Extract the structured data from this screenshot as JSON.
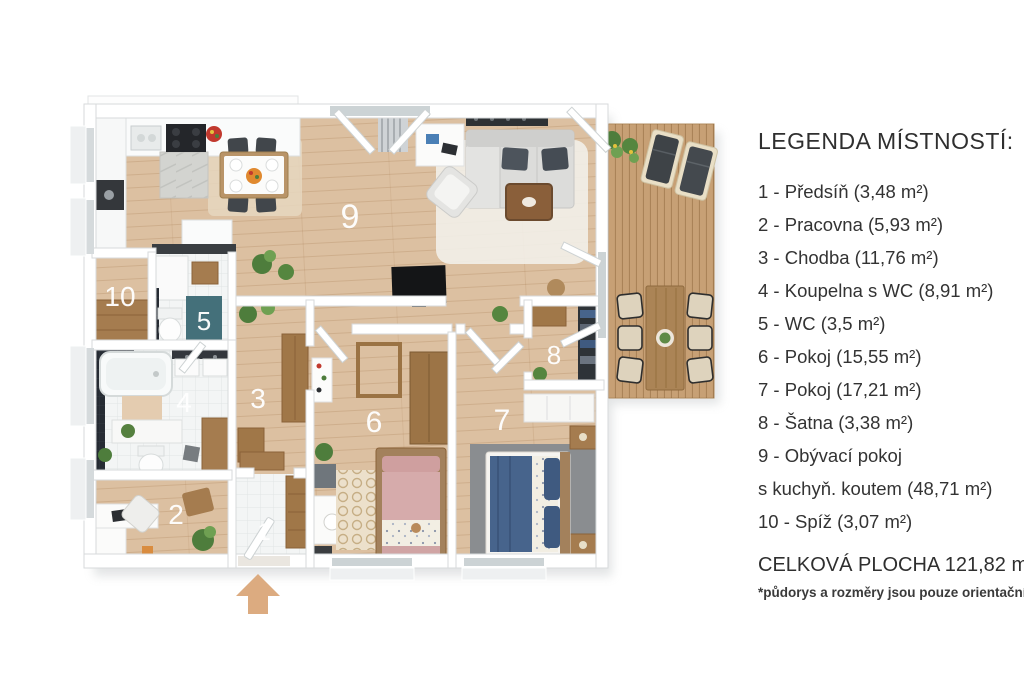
{
  "legend": {
    "title": "LEGENDA MÍSTNOSTÍ:",
    "items": [
      {
        "line1": "1 - Předsíň (3,48 m²)"
      },
      {
        "line1": "2 - Pracovna (5,93 m²)"
      },
      {
        "line1": "3 - Chodba (11,76 m²)"
      },
      {
        "line1": "4 - Koupelna s WC (8,91 m²)"
      },
      {
        "line1": "5 - WC (3,5 m²)"
      },
      {
        "line1": "6 - Pokoj (15,55 m²)"
      },
      {
        "line1": "7 - Pokoj (17,21 m²)"
      },
      {
        "line1": "8 - Šatna (3,38 m²)"
      },
      {
        "line1": "9 - Obývací pokoj",
        "line2": "s kuchyň. koutem (48,71 m²)"
      },
      {
        "line1": "10 - Spíž (3,07 m²)"
      }
    ],
    "total": "CELKOVÁ PLOCHA 121,82 m²",
    "disclaimer": "*půdorys a rozměry jsou pouze orientační"
  },
  "plan": {
    "labels": [
      {
        "number": "1",
        "room": "predsin"
      },
      {
        "number": "2",
        "room": "pracovna"
      },
      {
        "number": "3",
        "room": "chodba"
      },
      {
        "number": "4",
        "room": "koupelna-s-wc"
      },
      {
        "number": "5",
        "room": "wc"
      },
      {
        "number": "6",
        "room": "pokoj-6"
      },
      {
        "number": "7",
        "room": "pokoj-7"
      },
      {
        "number": "8",
        "room": "satna"
      },
      {
        "number": "9",
        "room": "obyvaci-pokoj-s-kuchyni"
      },
      {
        "number": "10",
        "room": "spiz"
      }
    ],
    "colors": {
      "floor_wood": "#dcc0a1",
      "deck_wood": "#c7a075",
      "tile": "#f3f5f5",
      "wall": "#ffffff",
      "teal_mat": "#44707a",
      "arrow": "#dcab80",
      "bed_blue": "#47648c",
      "bed_pink": "#d6abab",
      "label_text": "#ffffff",
      "legend_text": "#333333"
    }
  }
}
